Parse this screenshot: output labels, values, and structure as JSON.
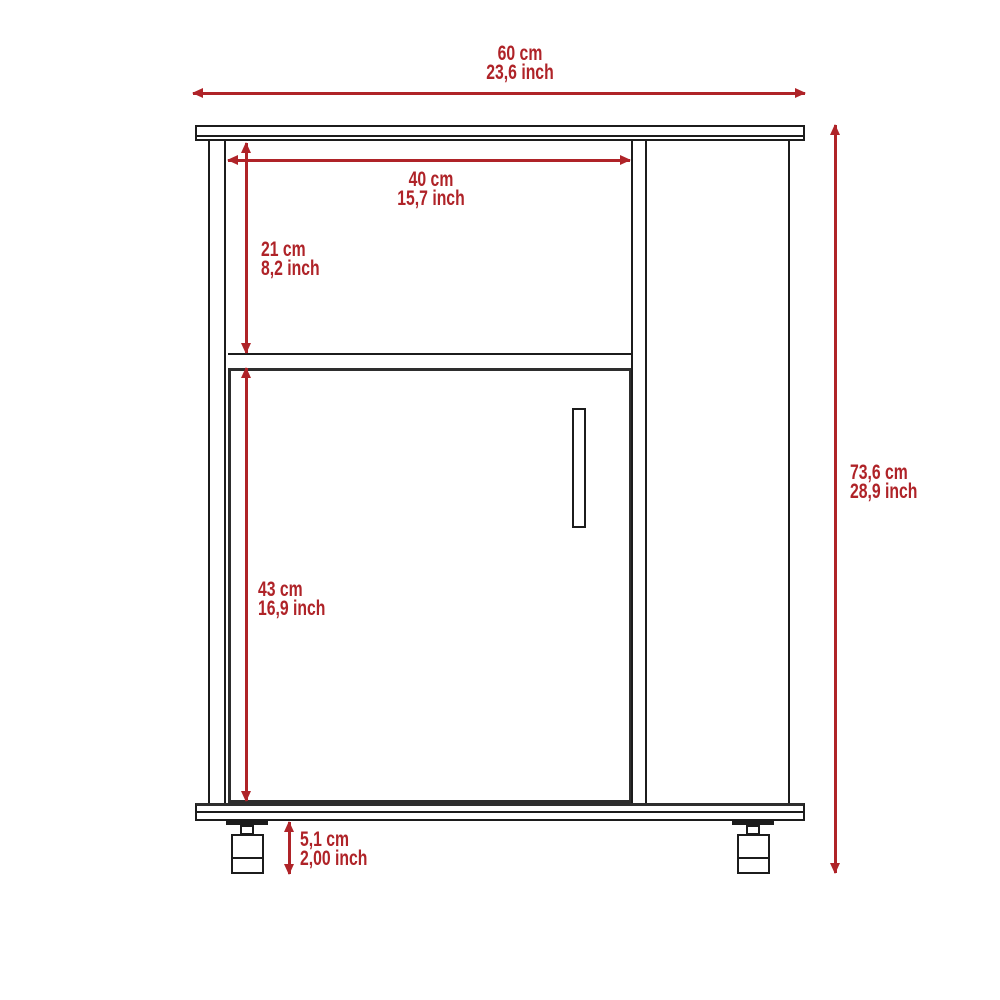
{
  "colors": {
    "dimension_red": "#af2328",
    "line_black": "#1c1c1c"
  },
  "diagram": {
    "subject": "kitchen-cabinet-front-elevation-with-casters",
    "dimensions": {
      "overall_width": {
        "cm": "60 cm",
        "inch": "23,6 inch"
      },
      "opening_width": {
        "cm": "40 cm",
        "inch": "15,7 inch"
      },
      "opening_height": {
        "cm": "21 cm",
        "inch": "8,2 inch"
      },
      "door_height": {
        "cm": "43 cm",
        "inch": "16,9 inch"
      },
      "caster_height": {
        "cm": "5,1 cm",
        "inch": "2,00 inch"
      },
      "overall_height": {
        "cm": "73,6 cm",
        "inch": "28,9 inch"
      }
    }
  }
}
